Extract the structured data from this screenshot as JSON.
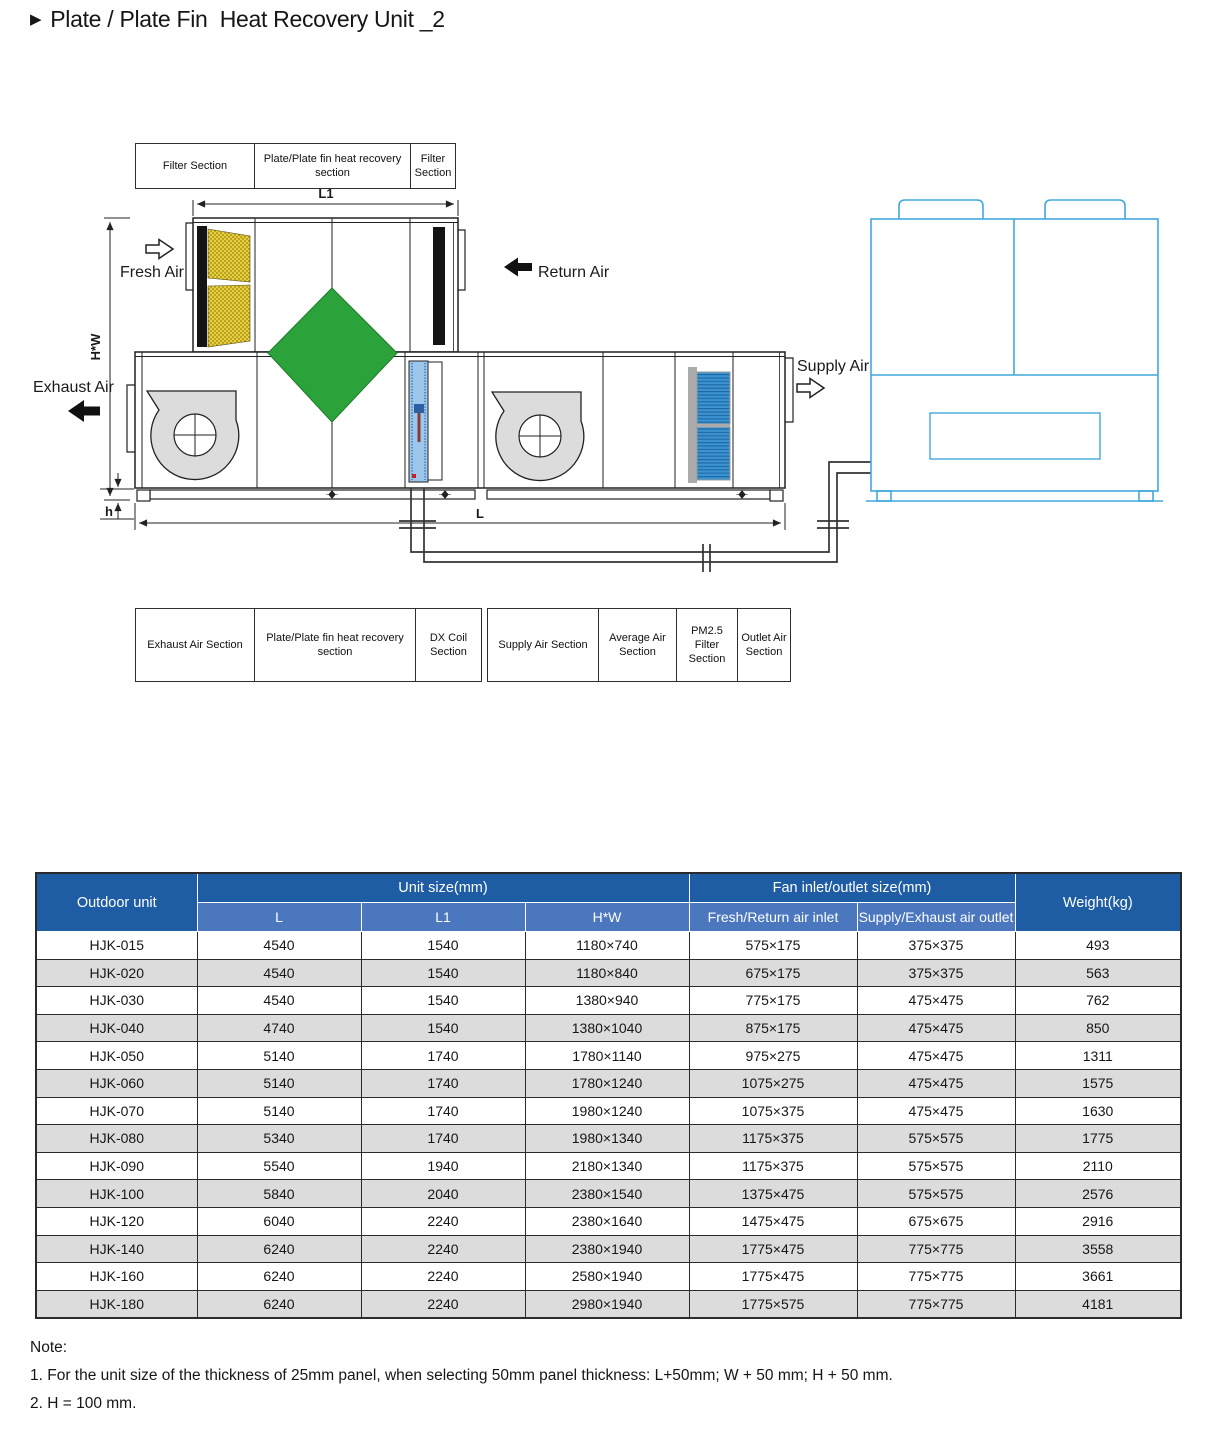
{
  "title": {
    "marker": "▶",
    "text": "Plate / Plate Fin  Heat Recovery Unit _2"
  },
  "diagram": {
    "top_section_labels": [
      "Filter Section",
      "Plate/Plate fin  heat recovery section",
      "Filter Section"
    ],
    "bottom_section_labels_left": [
      "Exhaust Air Section",
      "Plate/Plate fin  heat recovery section",
      "DX Coil Section"
    ],
    "bottom_section_labels_right": [
      "Supply Air Section",
      "Average Air Section",
      "PM2.5 Filter Section",
      "Outlet Air Section"
    ],
    "airflow": {
      "fresh": "Fresh Air",
      "return": "Return Air",
      "exhaust": "Exhaust Air",
      "supply": "Supply Air"
    },
    "dimensions": {
      "l1": "L1",
      "l": "L",
      "hw": "H*W",
      "h": "h"
    },
    "colors": {
      "outdoor_unit_outline": "#41A8DC",
      "heat_exchanger_green": "#2BA33A",
      "filter_yellow": "#E8CF3A",
      "dx_coil_blue": "#9CC6EA",
      "pm25_filter_blue": "#3D93D1"
    }
  },
  "table": {
    "header": {
      "outdoor_unit": "Outdoor unit",
      "unit_size": "Unit size(mm)",
      "fan_size": "Fan inlet/outlet size(mm)",
      "weight": "Weight(kg)",
      "sub": [
        "L",
        "L1",
        "H*W",
        "Fresh/Return air inlet",
        "Supply/Exhaust air outlet"
      ]
    },
    "colors": {
      "header_dark_blue": "#1E5CA4",
      "header_light_blue": "#4A77BE",
      "row_alt_gray": "#DCDCDC"
    },
    "rows": [
      [
        "HJK-015",
        "4540",
        "1540",
        "1180×740",
        "575×175",
        "375×375",
        "493"
      ],
      [
        "HJK-020",
        "4540",
        "1540",
        "1180×840",
        "675×175",
        "375×375",
        "563"
      ],
      [
        "HJK-030",
        "4540",
        "1540",
        "1380×940",
        "775×175",
        "475×475",
        "762"
      ],
      [
        "HJK-040",
        "4740",
        "1540",
        "1380×1040",
        "875×175",
        "475×475",
        "850"
      ],
      [
        "HJK-050",
        "5140",
        "1740",
        "1780×1140",
        "975×275",
        "475×475",
        "1311"
      ],
      [
        "HJK-060",
        "5140",
        "1740",
        "1780×1240",
        "1075×275",
        "475×475",
        "1575"
      ],
      [
        "HJK-070",
        "5140",
        "1740",
        "1980×1240",
        "1075×375",
        "475×475",
        "1630"
      ],
      [
        "HJK-080",
        "5340",
        "1740",
        "1980×1340",
        "1175×375",
        "575×575",
        "1775"
      ],
      [
        "HJK-090",
        "5540",
        "1940",
        "2180×1340",
        "1175×375",
        "575×575",
        "2110"
      ],
      [
        "HJK-100",
        "5840",
        "2040",
        "2380×1540",
        "1375×475",
        "575×575",
        "2576"
      ],
      [
        "HJK-120",
        "6040",
        "2240",
        "2380×1640",
        "1475×475",
        "675×675",
        "2916"
      ],
      [
        "HJK-140",
        "6240",
        "2240",
        "2380×1940",
        "1775×475",
        "775×775",
        "3558"
      ],
      [
        "HJK-160",
        "6240",
        "2240",
        "2580×1940",
        "1775×475",
        "775×775",
        "3661"
      ],
      [
        "HJK-180",
        "6240",
        "2240",
        "2980×1940",
        "1775×575",
        "775×775",
        "4181"
      ]
    ]
  },
  "notes": {
    "heading": "Note:",
    "items": [
      "1. For the unit size of the thickness of 25mm panel, when selecting 50mm panel thickness: L+50mm; W + 50 mm; H + 50 mm.",
      "2. H = 100 mm."
    ]
  }
}
